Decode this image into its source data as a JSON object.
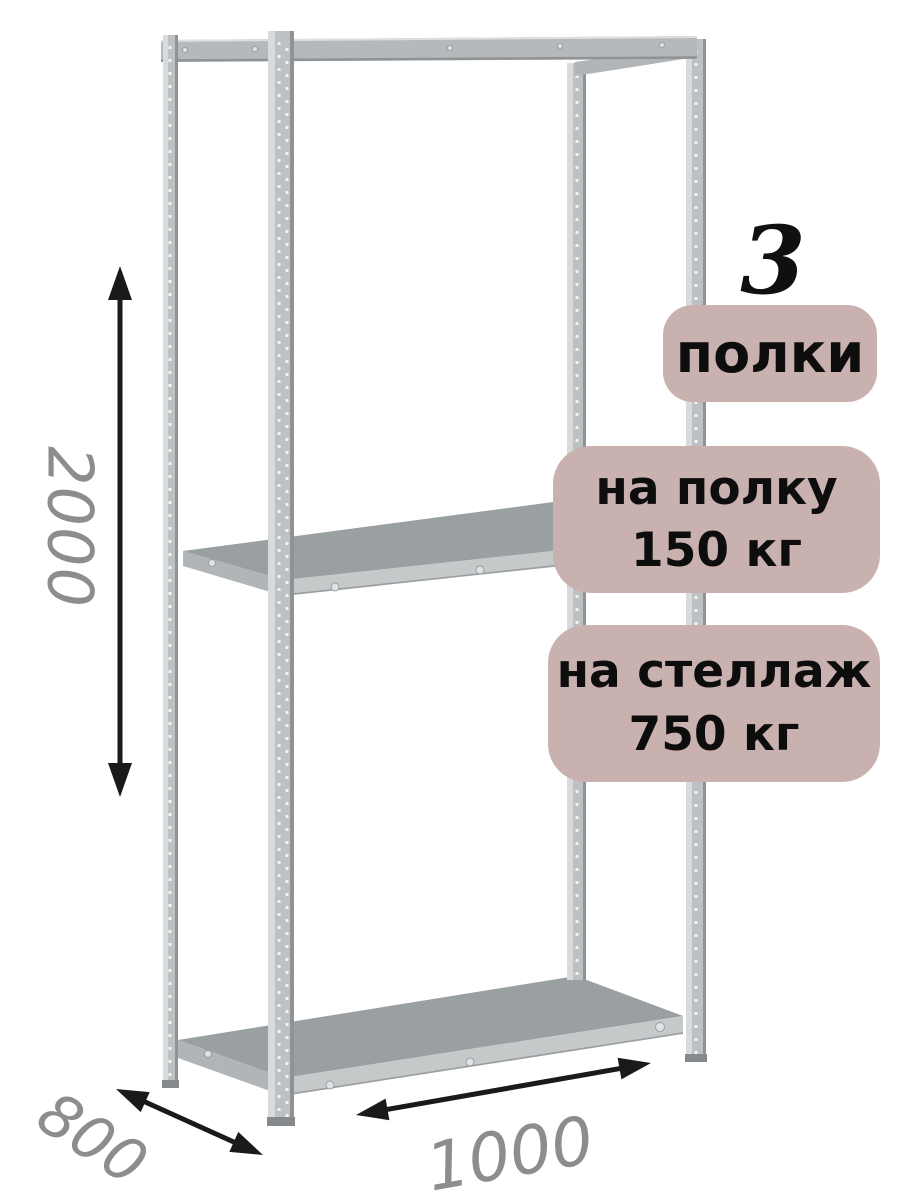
{
  "badges": {
    "shelf_count": {
      "number": "3",
      "label": "полки"
    },
    "shelf_load": {
      "line1": "на полку",
      "line2": "150 кг"
    },
    "rack_load": {
      "line1": "на стеллаж",
      "line2": "750 кг"
    }
  },
  "dimensions": {
    "height": "2000",
    "depth": "800",
    "width": "1000"
  },
  "colors": {
    "badge_bg": "#c9b1b0",
    "badge_text": "#0d0d0d",
    "dim_text": "#8d8d8d",
    "arrow": "#1a1a1a",
    "metal_mid": "#bdc1c3",
    "metal_light": "#d8dadb",
    "metal_dark": "#8f9396",
    "shelf_top": "#9aa0a2",
    "shelf_edge": "#c5c9ca"
  }
}
